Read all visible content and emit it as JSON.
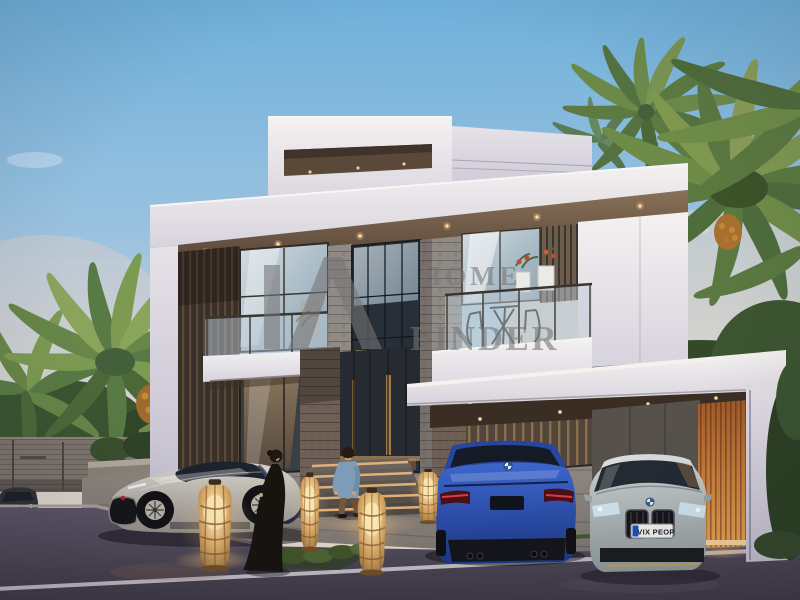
{
  "scene": {
    "type": "real-estate-render",
    "subject": "Modern two-storey luxury villa at dusk with palm trees, three luxury cars, two people and glowing wicker lanterns",
    "watermark": {
      "line1": "HOME",
      "line2": "FINDER"
    },
    "license_plate": "VIX PEOP"
  },
  "palette": {
    "sky_top": "#6fb0da",
    "sky_horizon": "#e8d8c8",
    "villa_white": "#eeebed",
    "wood_slats": "#39302a",
    "stone": "#908a86",
    "warm_light": "#e8b878",
    "orange_feature_wall": "#c87e3c",
    "palm_green": "#5f7e42",
    "street_asphalt": "#46414e",
    "bugatti_silver": "#b5b1a9",
    "bmw_m4_blue": "#2b50b0",
    "bmw_8_silver": "#aeb8ba"
  }
}
